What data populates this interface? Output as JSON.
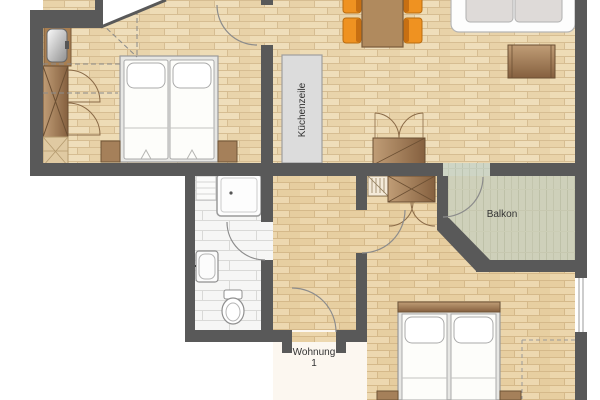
{
  "plan": {
    "labels": {
      "balcony": "Balkon",
      "apartment_line1": "Wohnung",
      "apartment_line2": "1",
      "kitchen_unit": "Küchenzeile"
    },
    "colors": {
      "wall": "#595959",
      "wood_floor": "#ecd9b3",
      "wood_joint": "#d6bd92",
      "bath_floor": "#f6f6f5",
      "balcony_floor": "#ced5c5",
      "furniture_brown": "#a5805a",
      "wardrobe_dark": "#8a6544",
      "chair_orange": "#ef9221",
      "chair_back_orange": "#c76f12",
      "bed_white": "#fdfdfa",
      "kitchen_gray": "#dcdcdc",
      "door_arc": "#8c8c8c",
      "label_text": "#333333"
    }
  }
}
